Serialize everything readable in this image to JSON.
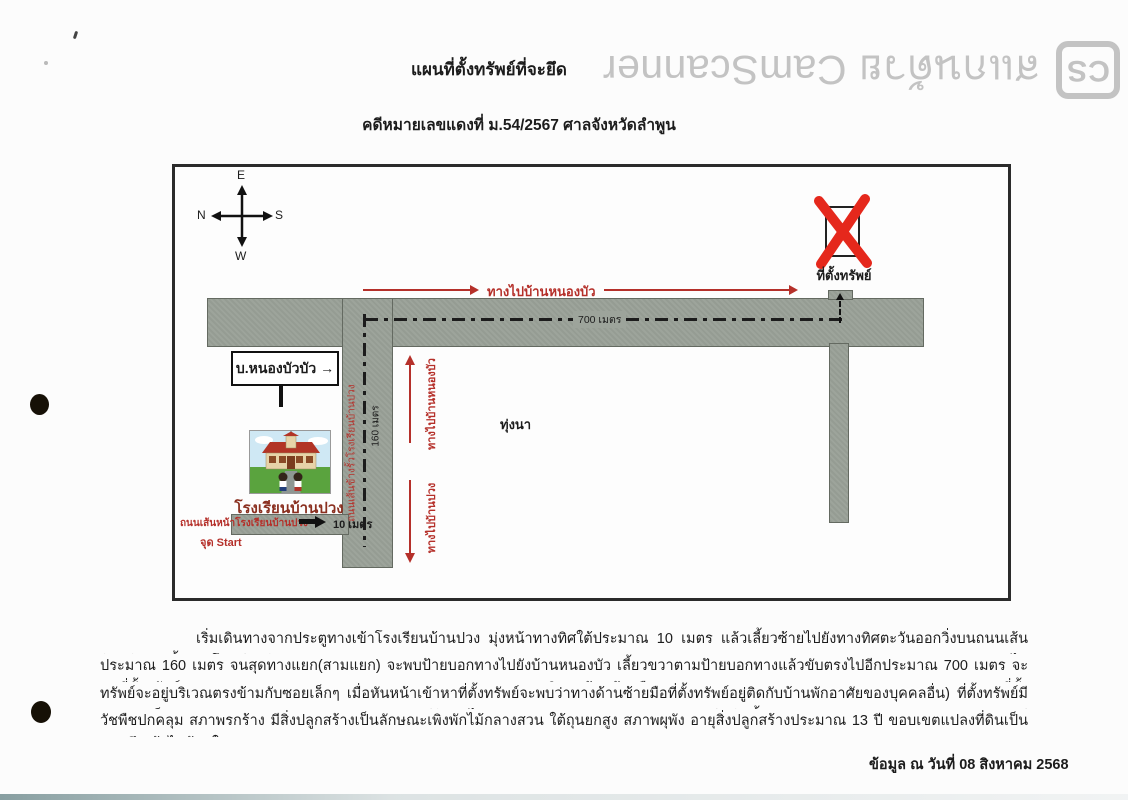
{
  "watermark": {
    "cs_logo": "CS",
    "text": "สแกนด้วย CamScanner"
  },
  "header": {
    "title": "แผนที่ตั้งทรัพย์ที่จะยึด",
    "case_line": "คดีหมายเลขแดงที่ ม.54/2567 ศาลจังหวัดลำพูน"
  },
  "map": {
    "compass": {
      "top": "E",
      "left": "N",
      "right": "S",
      "bottom": "W"
    },
    "property": {
      "mark": "X",
      "label": "ที่ตั้งทรัพย์"
    },
    "routes": {
      "to_nongbua_top": "ทางไปบ้านหนองบัว",
      "distance_700": "700 เมตร",
      "to_nongbua_side": "ทางไปบ้านหนองบัว",
      "to_banpuang_side": "ทางไปบ้านปวง",
      "distance_160": "160 เมตร",
      "distance_10": "10 เมตร",
      "side_road_name": "ถนนเส้นข้างรั้วโรงเรียนบ้านปวง",
      "front_road_name": "ถนนเส้นหน้าโรงเรียนบ้านปวง",
      "start_point": "จุด Start"
    },
    "places": {
      "village_sign": "บ.หนองบัวบัว →",
      "school_name": "โรงเรียนบ้านปวง",
      "field": "ทุ่งนา"
    },
    "colors": {
      "road": "#9da49b",
      "route_red": "#b5302a",
      "mark_red": "#e5281c"
    }
  },
  "description": {
    "lines": [
      "เริ่มเดินทางจากประตูทางเข้าโรงเรียนบ้านปวง มุ่งหน้าทางทิศใต้ประมาณ 10 เมตร แล้วเลี้ยวซ้ายไปยังทางทิศตะวันออกวิ่งบนถนนเส้นด้านข้างริมรั้วของโรงเรียนบ้านปวง ขับตรงไป",
      "ประมาณ 160 เมตร จนสุดทางแยก(สามแยก) จะพบป้ายบอกทางไปยังบ้านหนองบัว เลี้ยวขวาตามป้ายบอกทางแล้วขับตรงไปอีกประมาณ 700 เมตร จะพบที่ตั้งทรัพย์อยู่ บริเวณด้านซ้ายมือ (ที่ตั้ง",
      "ทรัพย์จะอยู่บริเวณตรงข้ามกับซอยเล็กๆ เมื่อหันหน้าเข้าหาที่ตั้งทรัพย์จะพบว่าทางด้านซ้ายมือที่ตั้งทรัพย์อยู่ติดกับบ้านพักอาศัยของบุคคลอื่น) ที่ตั้งทรัพย์มีลักษณะเป็นสวน มีต้นลำไย มีหญ้าขึ้น และมี",
      "วัชพืชปกคลุม สภาพรกร้าง มีสิ่งปลูกสร้างเป็นลักษณะเพิงพักไม้กลางสวน ใต้ถุนยกสูง สภาพผุพัง อายุสิ่งปลูกสร้างประมาณ 13 ปี ขอบเขตแปลงที่ดินเป็นแนวลึกเข้าไปด้านใน"
    ]
  },
  "footer": {
    "date_line": "ข้อมูล ณ วันที่ 08 สิงหาคม 2568"
  }
}
